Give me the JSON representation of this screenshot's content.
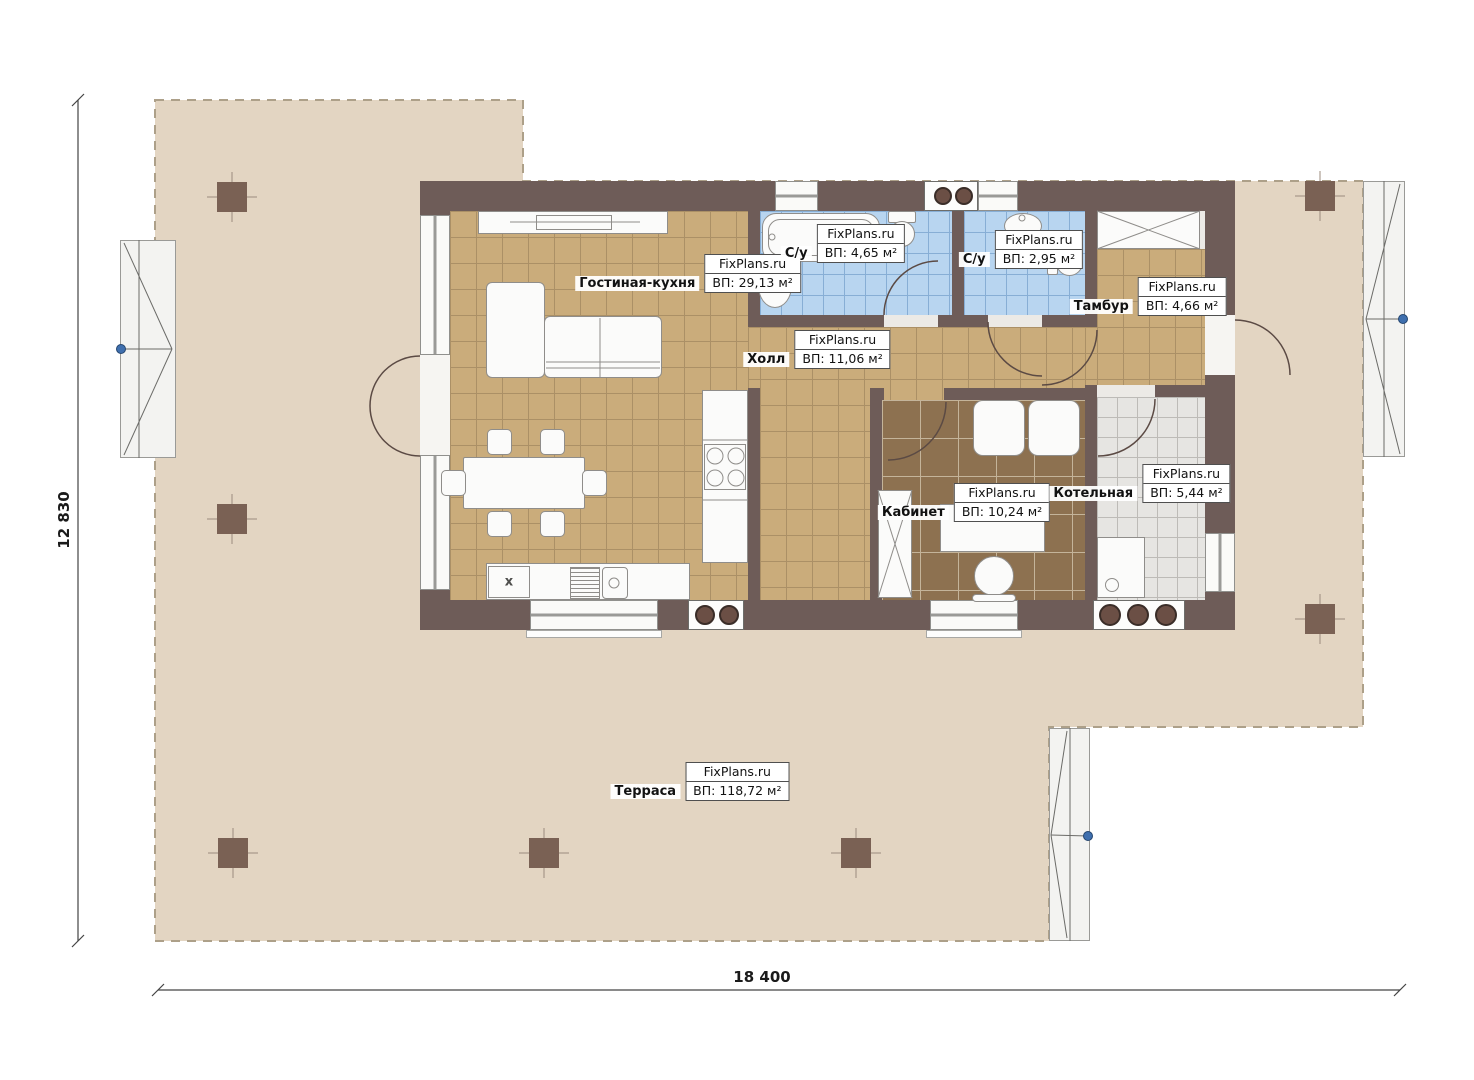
{
  "title": "House floor plan",
  "watermark": "FixPlans.ru",
  "dimensions": {
    "height_label": "12 830",
    "width_label": "18 400"
  },
  "rooms": [
    {
      "id": "living",
      "name": "Гостиная-кухня",
      "watermark": "FixPlans.ru",
      "area": "ВП: 29,13 м²"
    },
    {
      "id": "bath1",
      "name": "С/у",
      "watermark": "FixPlans.ru",
      "area": "ВП: 4,65 м²"
    },
    {
      "id": "bath2",
      "name": "С/у",
      "watermark": "FixPlans.ru",
      "area": "ВП: 2,95 м²"
    },
    {
      "id": "tambur",
      "name": "Тамбур",
      "watermark": "FixPlans.ru",
      "area": "ВП: 4,66 м²"
    },
    {
      "id": "hall",
      "name": "Холл",
      "watermark": "FixPlans.ru",
      "area": "ВП: 11,06 м²"
    },
    {
      "id": "cabinet",
      "name": "Кабинет",
      "watermark": "FixPlans.ru",
      "area": "ВП: 10,24 м²"
    },
    {
      "id": "boiler",
      "name": "Котельная",
      "watermark": "FixPlans.ru",
      "area": "ВП: 5,44 м²"
    },
    {
      "id": "terrace",
      "name": "Терраса",
      "watermark": "FixPlans.ru",
      "area": "ВП: 118,72 м²"
    }
  ],
  "symbols": {
    "dishwasher_mark": "х"
  },
  "colors": {
    "wall": "#6e5c58",
    "column": "#7a6154",
    "terrace": "#e3d5c2",
    "floor_living": "#caac7b",
    "floor_study": "#8d7150",
    "floor_bath": "#b8d5f0",
    "floor_boiler": "#e6e5e2",
    "window_marker_blue": "#3f6fae"
  }
}
